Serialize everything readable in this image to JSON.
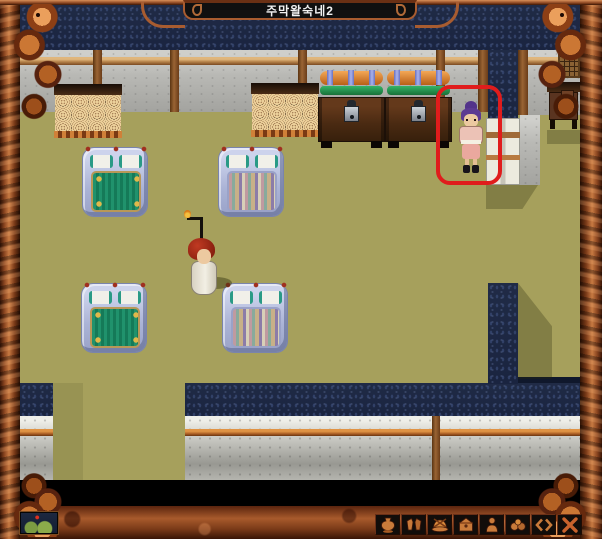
{
  "window": {
    "title": "주막왈숙네2"
  },
  "scene": {
    "location_type": "inn-interior",
    "highlight": {
      "shape": "rounded-rectangle",
      "color": "#e01c1c",
      "target": "npc"
    },
    "entities": [
      {
        "name": "player-character",
        "appearance": "white-robed figure carrying a lamp staff"
      },
      {
        "name": "npc",
        "appearance": "purple-haired villager inside red highlight box"
      }
    ],
    "furniture": [
      "dresser",
      "dresser",
      "storage-chest-with-bedding",
      "storage-chest-with-bedding",
      "bed-green",
      "bed-striped",
      "bed-green",
      "bed-striped",
      "desk",
      "lattice-window"
    ]
  },
  "colors": {
    "frame_copper": "#9a5126",
    "floor_olive": "#a6a05c",
    "outside_navy": "#202b46",
    "wall_gray": "#b9b9b5",
    "highlight_red": "#e01c1c",
    "icon_copper": "#c87a3a"
  },
  "toolbar": {
    "buttons": [
      {
        "name": "vessel-button",
        "icon": "vessel-icon"
      },
      {
        "name": "armor-button",
        "icon": "armor-icon"
      },
      {
        "name": "food-button",
        "icon": "food-plate-icon"
      },
      {
        "name": "satchel-button",
        "icon": "satchel-icon"
      },
      {
        "name": "character-button",
        "icon": "person-icon"
      },
      {
        "name": "bundle-button",
        "icon": "bundle-icon"
      },
      {
        "name": "exchange-button",
        "icon": "exchange-arrows-icon"
      },
      {
        "name": "close-button",
        "icon": "close-x-icon"
      }
    ]
  },
  "minimap": {
    "name": "minimap-preview"
  }
}
